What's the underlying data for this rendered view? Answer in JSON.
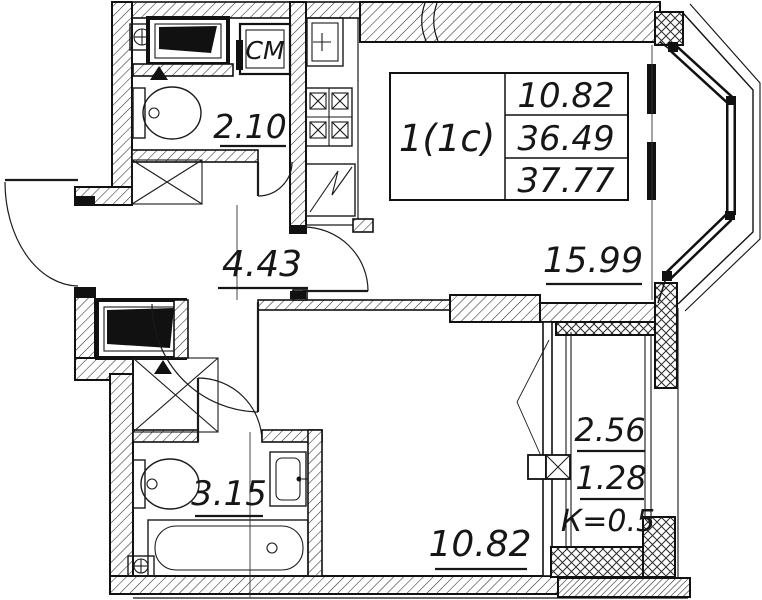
{
  "plan": {
    "apartment_card": {
      "type_label": "1(1с)",
      "rows": [
        "10.82",
        "36.49",
        "37.77"
      ]
    },
    "rooms": {
      "bathroom_top": "2.10",
      "hallway": "4.43",
      "living_kitchen": "15.99",
      "bathroom_bottom": "3.15",
      "bedroom": "10.82",
      "balcony_area": "2.56",
      "balcony_reduced_area": "1.28",
      "balcony_coefficient": "К=0.5"
    },
    "appliances": {
      "washing_machine": "СМ"
    },
    "colors": {
      "line": "#1a1a1a",
      "background": "#ffffff"
    }
  }
}
